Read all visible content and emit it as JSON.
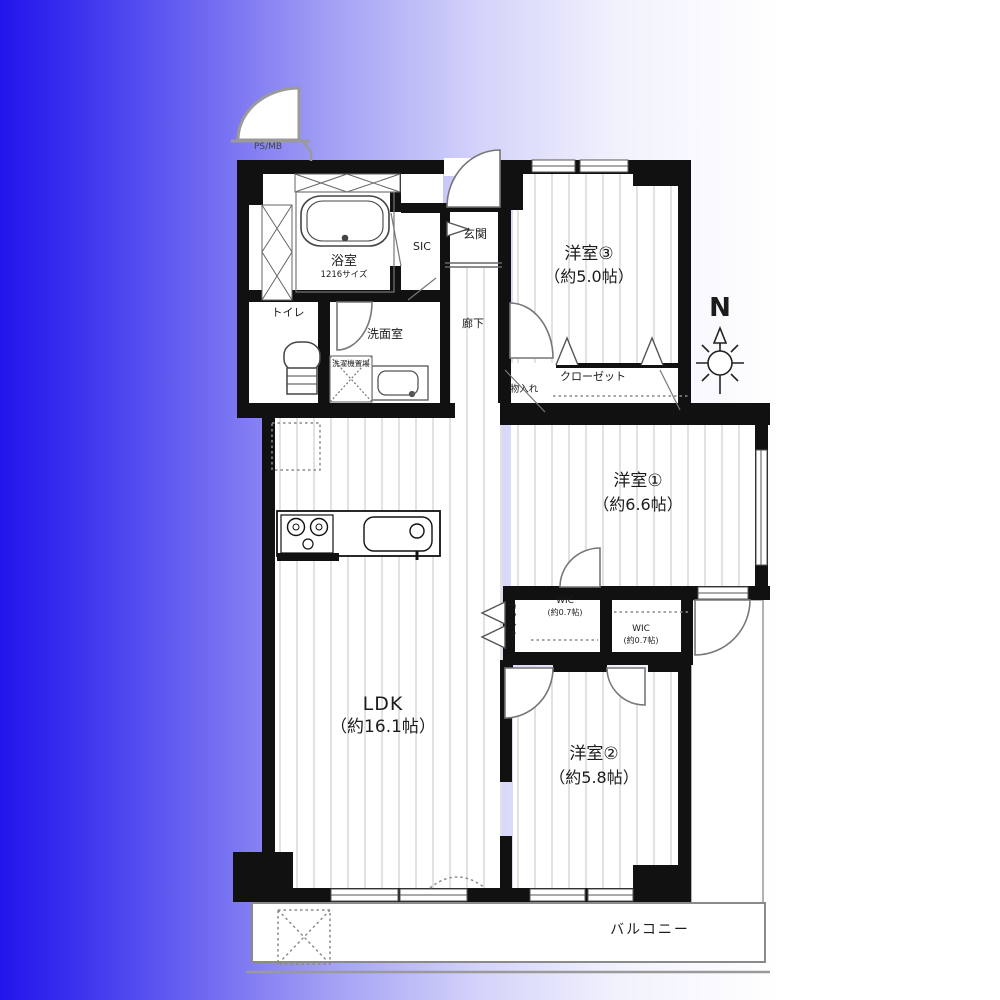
{
  "background": {
    "gradient_left": "#2214ec",
    "gradient_right": "#ffffff",
    "wall_color": "#111111",
    "floor_line_color": "#c4c4c4"
  },
  "compass": {
    "label": "N"
  },
  "rooms": {
    "ldk": {
      "name": "LDK",
      "size": "（約16.1帖）"
    },
    "bedroom1": {
      "name": "洋室①",
      "size": "（約6.6帖）"
    },
    "bedroom2": {
      "name": "洋室②",
      "size": "（約5.8帖）"
    },
    "bedroom3": {
      "name": "洋室③",
      "size": "（約5.0帖）"
    },
    "bath": {
      "name": "浴室",
      "size": "1216サイズ"
    },
    "washroom": {
      "name": "洗面室"
    },
    "laundry": {
      "name": "洗濯機置場"
    },
    "toilet": {
      "name": "トイレ"
    },
    "hallway": {
      "name": "廊下"
    },
    "entrance": {
      "name": "玄関"
    },
    "shoe_closet": {
      "name": "SIC"
    },
    "storage": {
      "name": "物入れ"
    },
    "closet": {
      "name": "クローゼット"
    },
    "wic1": {
      "name": "WIC",
      "size": "(約0.7帖)"
    },
    "wic2": {
      "name": "WIC",
      "size": "(約0.7帖)"
    },
    "counter": {
      "name": "カウンター"
    },
    "balcony": {
      "name": "バルコニー"
    },
    "pipe_space": {
      "name": "PS/MB"
    }
  }
}
